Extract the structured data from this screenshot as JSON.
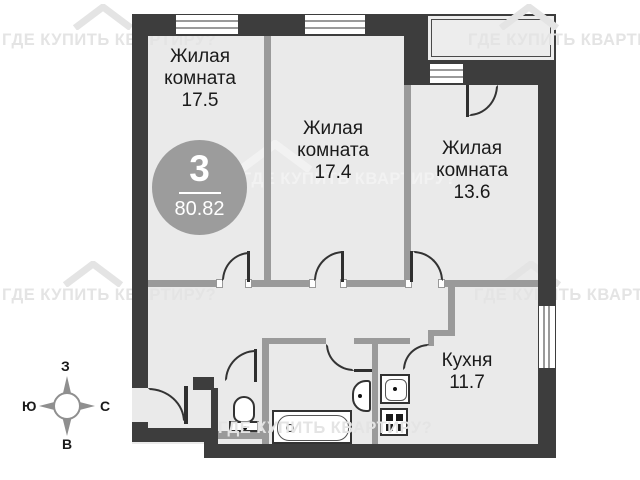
{
  "plan": {
    "type": "apartment-floor-plan",
    "rooms": [
      {
        "name": "Жилая комната",
        "area": "17.5"
      },
      {
        "name": "Жилая комната",
        "area": "17.4"
      },
      {
        "name": "Жилая комната",
        "area": "13.6"
      },
      {
        "name": "Кухня",
        "area": "11.7"
      }
    ],
    "badge": {
      "rooms_count": "3",
      "total_area": "80.82"
    }
  },
  "compass": {
    "top": "З",
    "left": "Ю",
    "right": "С",
    "bottom": "В"
  },
  "watermark": {
    "text": "ГДЕ КУПИТЬ КВАРТИРУ?"
  },
  "colors": {
    "wall_dark": "#3d3d3d",
    "wall_light": "#9a9a9a",
    "floor": "#eaeaea",
    "badge_bg": "#9c9c9c",
    "watermark": "#e4e4e4"
  }
}
